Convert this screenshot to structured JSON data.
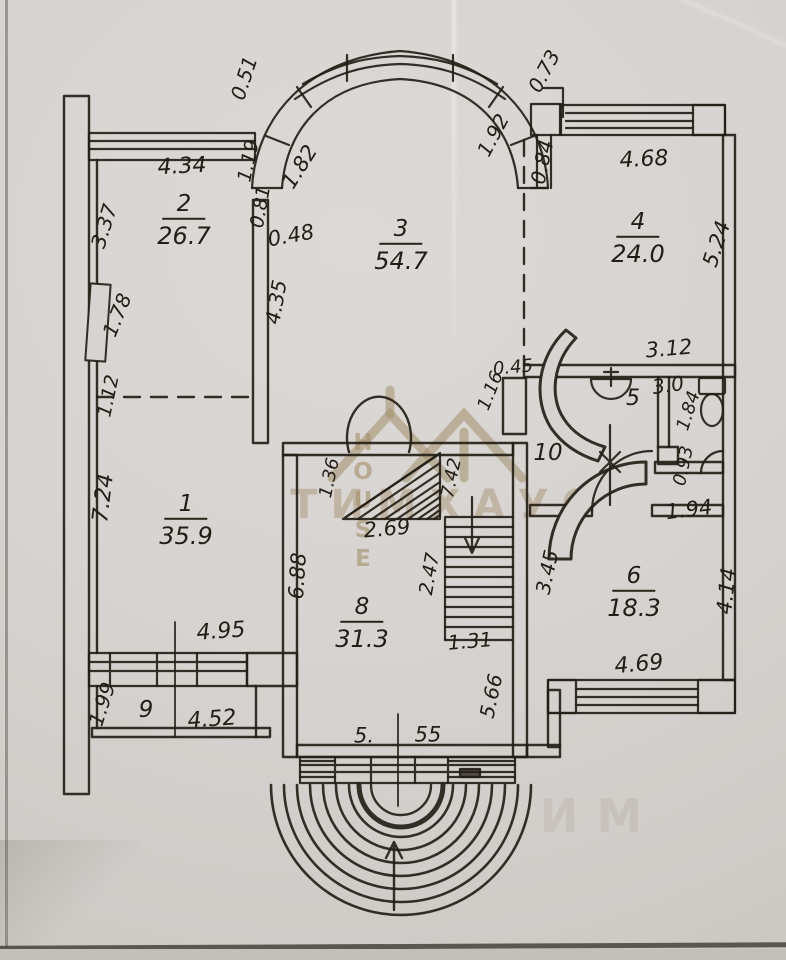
{
  "watermark": {
    "house": "HOUSE",
    "brand": "ТИМХАУС",
    "fragment": "ИМ"
  },
  "rooms": {
    "r1": {
      "num": "1",
      "area": "35.9"
    },
    "r2": {
      "num": "2",
      "area": "26.7"
    },
    "r3": {
      "num": "3",
      "area": "54.7"
    },
    "r4": {
      "num": "4",
      "area": "24.0"
    },
    "r5": {
      "num": "5",
      "area": "3.0"
    },
    "r6": {
      "num": "6",
      "area": "18.3"
    },
    "r8": {
      "num": "8",
      "area": "31.3"
    },
    "r9": {
      "num": "9"
    },
    "r10": {
      "num": "10"
    }
  },
  "dims": {
    "d434": "4.34",
    "d051": "0.51",
    "d119": "1.19",
    "d081": "0.81",
    "d182": "1.82",
    "d048": "0.48",
    "d337": "3.37",
    "d178": "1.78",
    "d112": "1.12",
    "d724": "7.24",
    "d435": "4.35",
    "d192": "1.92",
    "d073": "0.73",
    "d084": "0.84",
    "d468": "4.68",
    "d524": "5.24",
    "d312": "3.12",
    "d045": "0.45",
    "d116": "1.16",
    "d184": "1.84",
    "d093": "0.93",
    "d194": "1.94",
    "d414": "4.14",
    "d136": "1.36",
    "d269": "2.69",
    "d742": "7.42",
    "d247": "2.47",
    "d131": "1.31",
    "d345": "3.45",
    "d688": "6.88",
    "d495": "4.95",
    "d199": "1.99",
    "d452": "4.52",
    "d5": "5.",
    "d55": "55",
    "d566": "5.66",
    "d469": "4.69"
  }
}
